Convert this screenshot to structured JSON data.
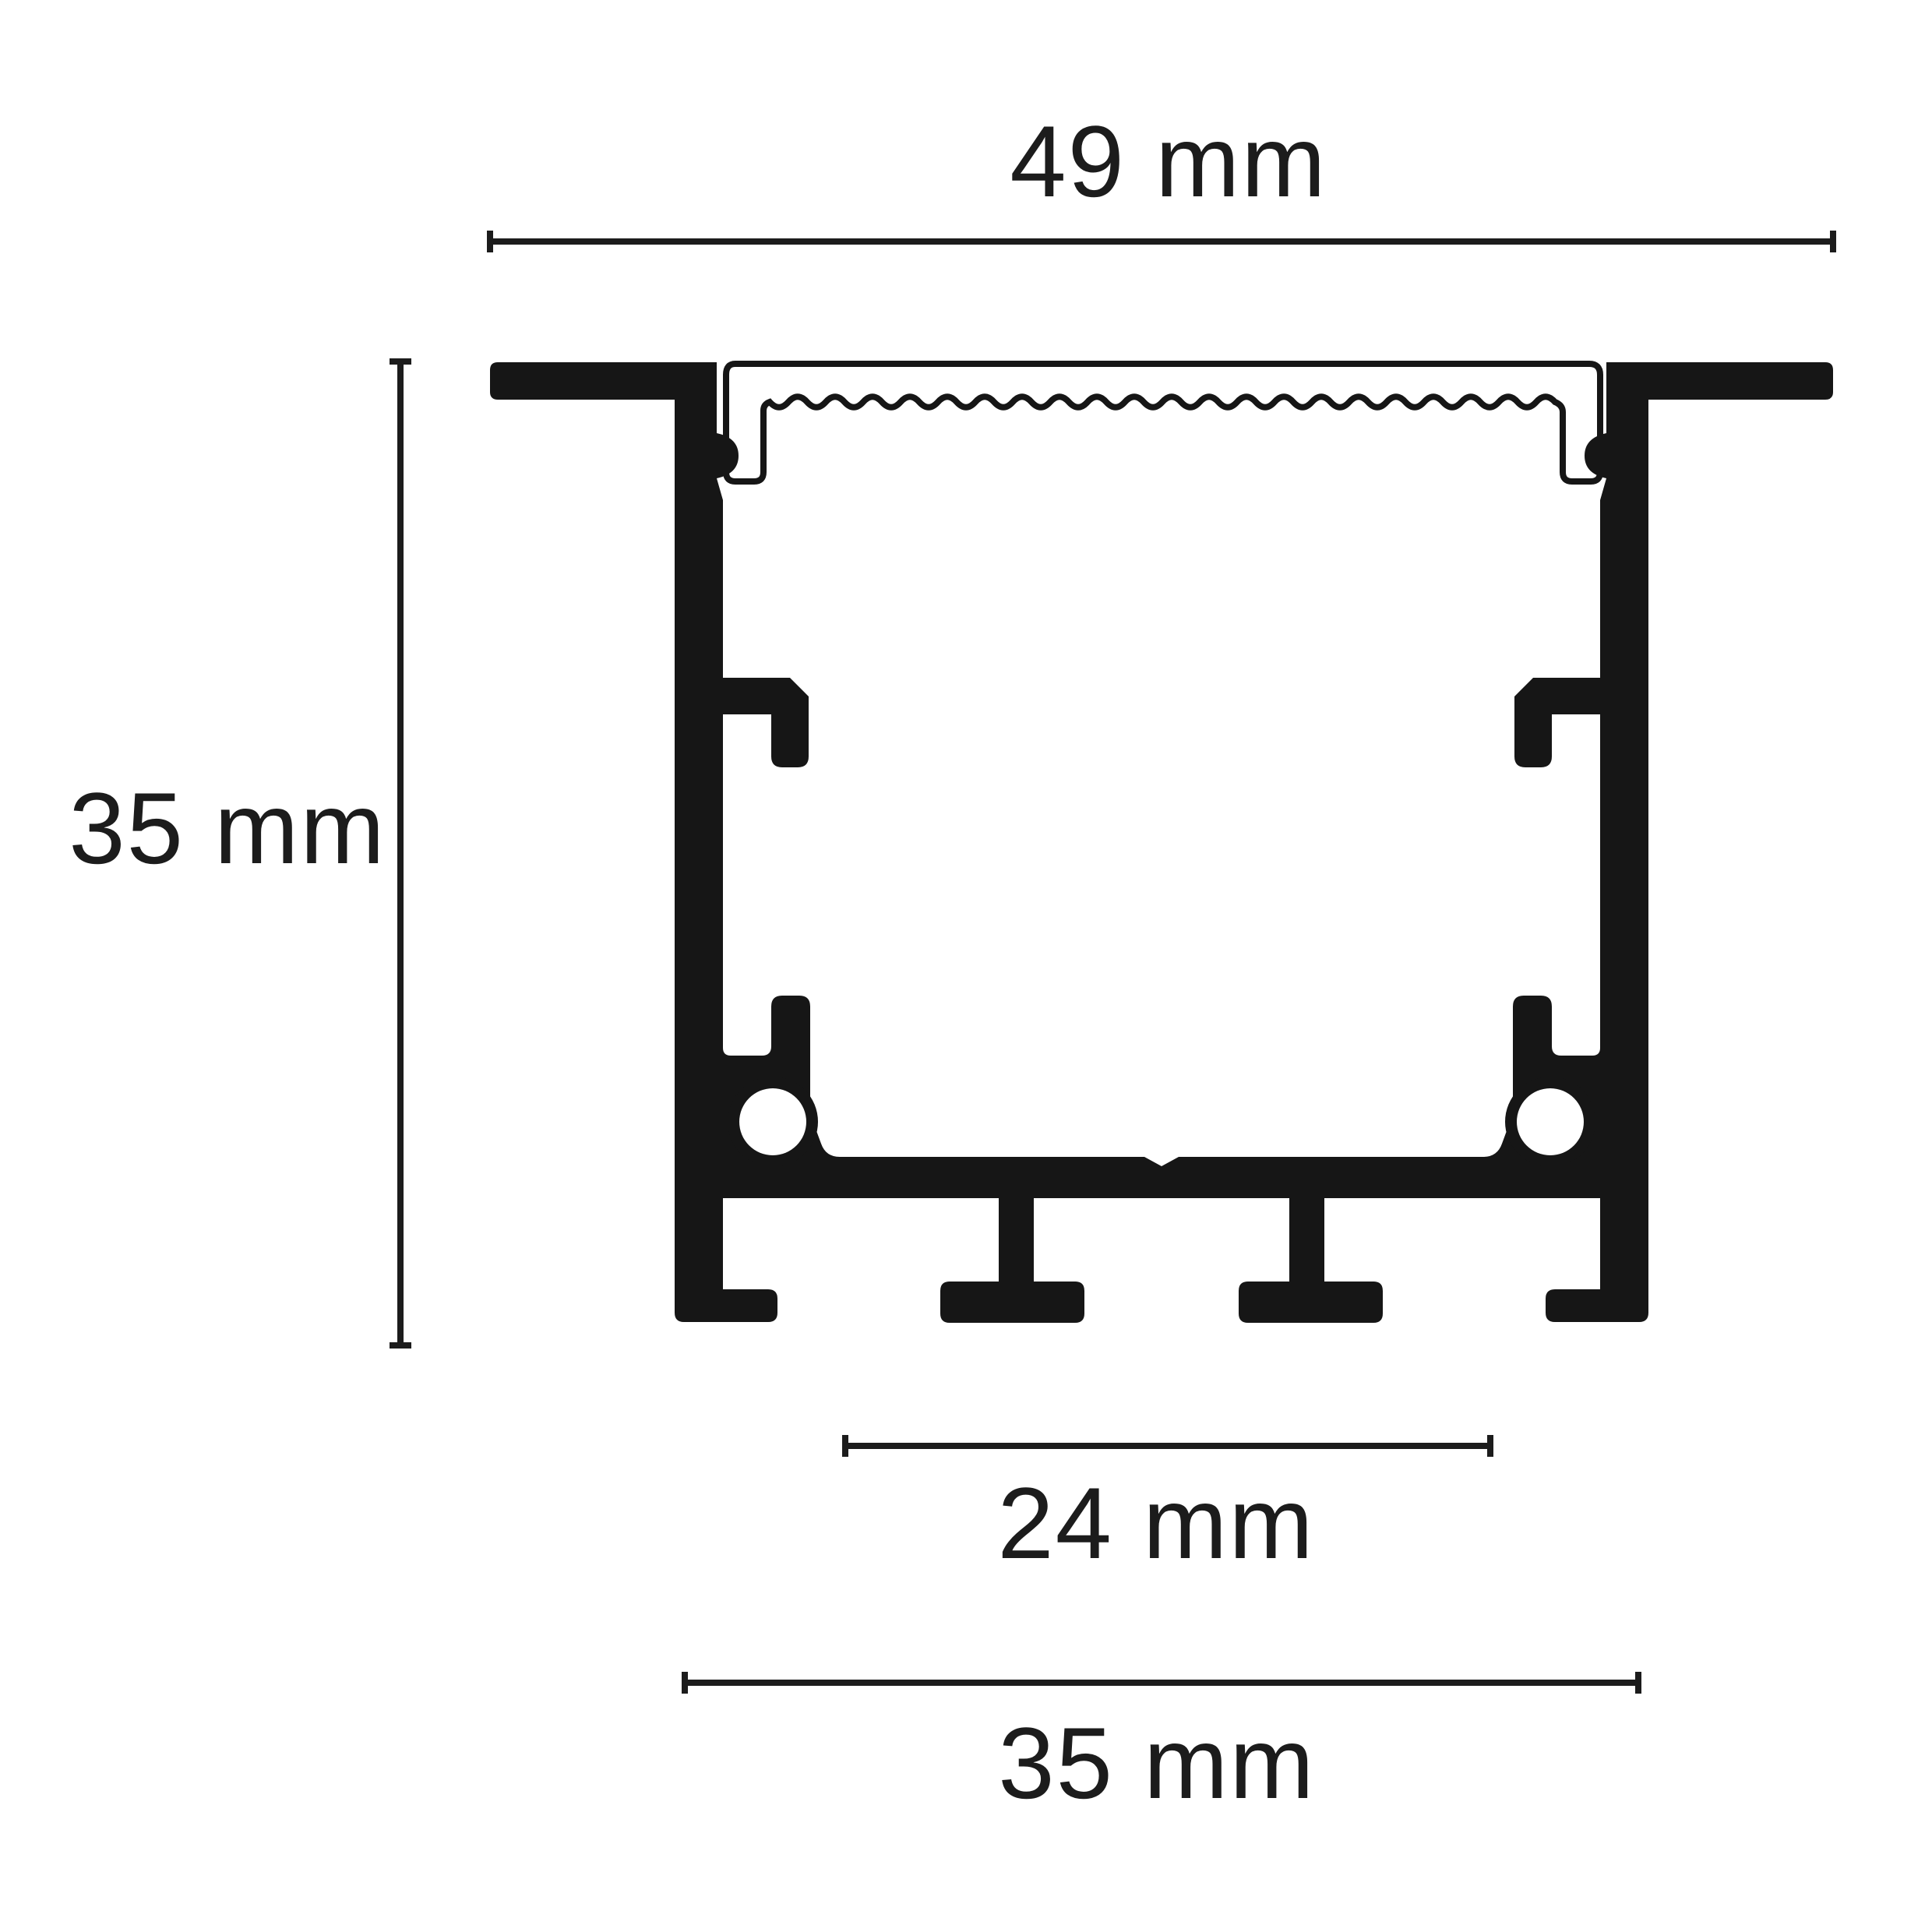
{
  "diagram": {
    "type": "technical-cross-section",
    "subject": "recessed-aluminum-led-profile",
    "dimensions": {
      "top_width": {
        "label": "49 mm"
      },
      "left_height": {
        "label": "35 mm"
      },
      "bottom_inner": {
        "label": "24 mm"
      },
      "bottom_outer": {
        "label": "35 mm"
      }
    },
    "parts": {
      "profile_body": "aluminum extrusion body",
      "diffuser_cover": "frosted cover with rippled underside",
      "screw_boss": "round screw port",
      "mounting_clip": "internal bracket clip",
      "bottom_ribs": "t-shaped base ribs"
    },
    "colors": {
      "ink": "#161616",
      "background": "#ffffff",
      "cover_fill": "#ffffff"
    }
  }
}
